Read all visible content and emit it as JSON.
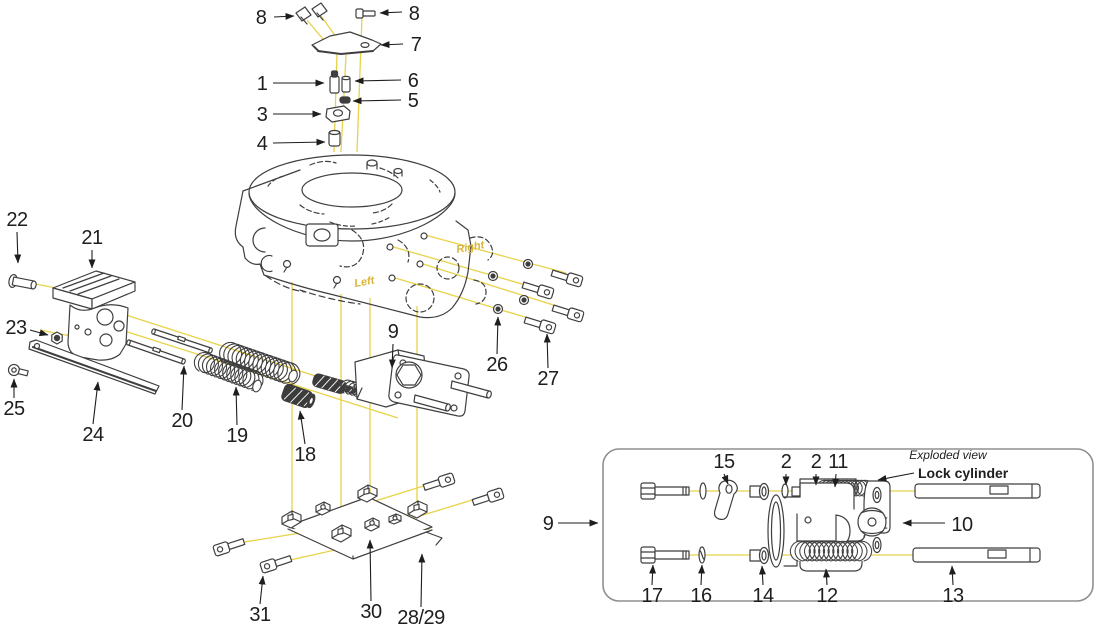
{
  "diagram": {
    "type": "exploded-parts-diagram",
    "labels": {
      "p1": "1",
      "p2a": "2",
      "p2b": "2",
      "p3": "3",
      "p4": "4",
      "p5": "5",
      "p6": "6",
      "p7": "7",
      "p8a": "8",
      "p8b": "8",
      "p9_main": "9",
      "p9_box": "9",
      "p10": "10",
      "p11": "11",
      "p12": "12",
      "p13": "13",
      "p14": "14",
      "p15": "15",
      "p16": "16",
      "p17": "17",
      "p18": "18",
      "p19": "19",
      "p20": "20",
      "p21": "21",
      "p22": "22",
      "p23": "23",
      "p24": "24",
      "p25": "25",
      "p26": "26",
      "p27": "27",
      "p2829": "28/29",
      "p30": "30",
      "p31": "31"
    },
    "annotations": {
      "left": "Left",
      "right": "Right",
      "exploded_view": "Exploded view",
      "lock_cylinder": "Lock cylinder"
    },
    "colors": {
      "leader_line": "#e8d24a",
      "drawing_line": "#3f3f3f",
      "label_text": "#1e1e1e",
      "annotation_text": "#d8b53a",
      "box_border": "#8f8f8f"
    }
  }
}
